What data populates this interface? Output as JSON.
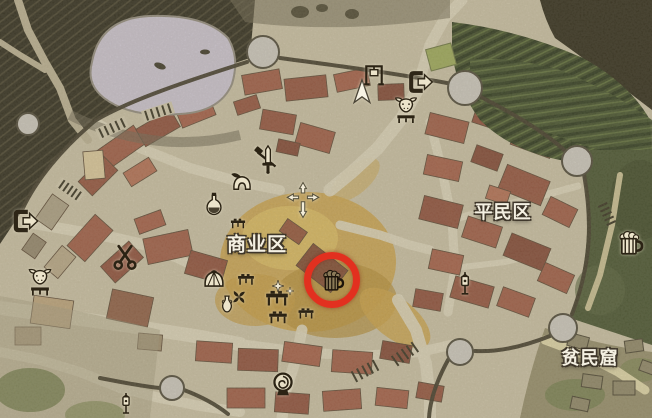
{
  "map": {
    "districts": [
      {
        "id": "commercial",
        "label": "商业区",
        "x": 257,
        "y": 243,
        "size": 19
      },
      {
        "id": "commoner",
        "label": "平民区",
        "x": 503,
        "y": 211,
        "size": 18
      },
      {
        "id": "slum",
        "label": "贫民窟",
        "x": 590,
        "y": 357,
        "size": 18
      }
    ],
    "highlight": {
      "x": 332,
      "y": 280,
      "radius": 28,
      "ring_width": 7,
      "color": "#e2301f",
      "icon": "tavern-mug-icon",
      "icon_size": 27
    },
    "icons": [
      {
        "name": "city-gate-icon",
        "x": 25,
        "y": 221,
        "size": 30
      },
      {
        "name": "city-gate-icon",
        "x": 420,
        "y": 82,
        "size": 29
      },
      {
        "name": "oxcart-icon",
        "x": 40,
        "y": 283,
        "size": 32
      },
      {
        "name": "oxcart-icon",
        "x": 406,
        "y": 111,
        "size": 31
      },
      {
        "name": "scissors-icon",
        "x": 125,
        "y": 257,
        "size": 27
      },
      {
        "name": "weapon-shop-icon",
        "x": 268,
        "y": 159,
        "size": 30
      },
      {
        "name": "armor-shop-icon",
        "x": 242,
        "y": 183,
        "size": 25
      },
      {
        "name": "apothecary-icon",
        "x": 214,
        "y": 204,
        "size": 26
      },
      {
        "name": "tavern-mug-icon",
        "x": 630,
        "y": 243,
        "size": 31
      },
      {
        "name": "player-cursor-icon",
        "x": 362,
        "y": 92,
        "size": 28
      },
      {
        "name": "gallows-icon",
        "x": 374,
        "y": 74,
        "size": 24
      },
      {
        "name": "crossroad-arrows-icon",
        "x": 303,
        "y": 200,
        "size": 42
      },
      {
        "name": "well-icon",
        "x": 283,
        "y": 384,
        "size": 27
      },
      {
        "name": "lamp-post-icon",
        "x": 465,
        "y": 283,
        "size": 25
      },
      {
        "name": "lamp-post-icon",
        "x": 126,
        "y": 403,
        "size": 23
      },
      {
        "name": "pinwheel-icon",
        "x": 239,
        "y": 297,
        "size": 17
      },
      {
        "name": "jug-icon",
        "x": 227,
        "y": 304,
        "size": 19
      },
      {
        "name": "goods-basket-icon",
        "x": 214,
        "y": 279,
        "size": 23
      },
      {
        "name": "market-stall-icon",
        "x": 246,
        "y": 280,
        "size": 19
      },
      {
        "name": "market-stall-icon",
        "x": 277,
        "y": 299,
        "size": 26
      },
      {
        "name": "market-stall-icon",
        "x": 278,
        "y": 318,
        "size": 21
      },
      {
        "name": "market-stall-icon",
        "x": 306,
        "y": 314,
        "size": 18
      },
      {
        "name": "market-stall-icon",
        "x": 238,
        "y": 224,
        "size": 17
      },
      {
        "name": "sparkle-icon",
        "x": 278,
        "y": 286,
        "size": 12
      },
      {
        "name": "sparkle-icon",
        "x": 290,
        "y": 291,
        "size": 8
      }
    ]
  }
}
